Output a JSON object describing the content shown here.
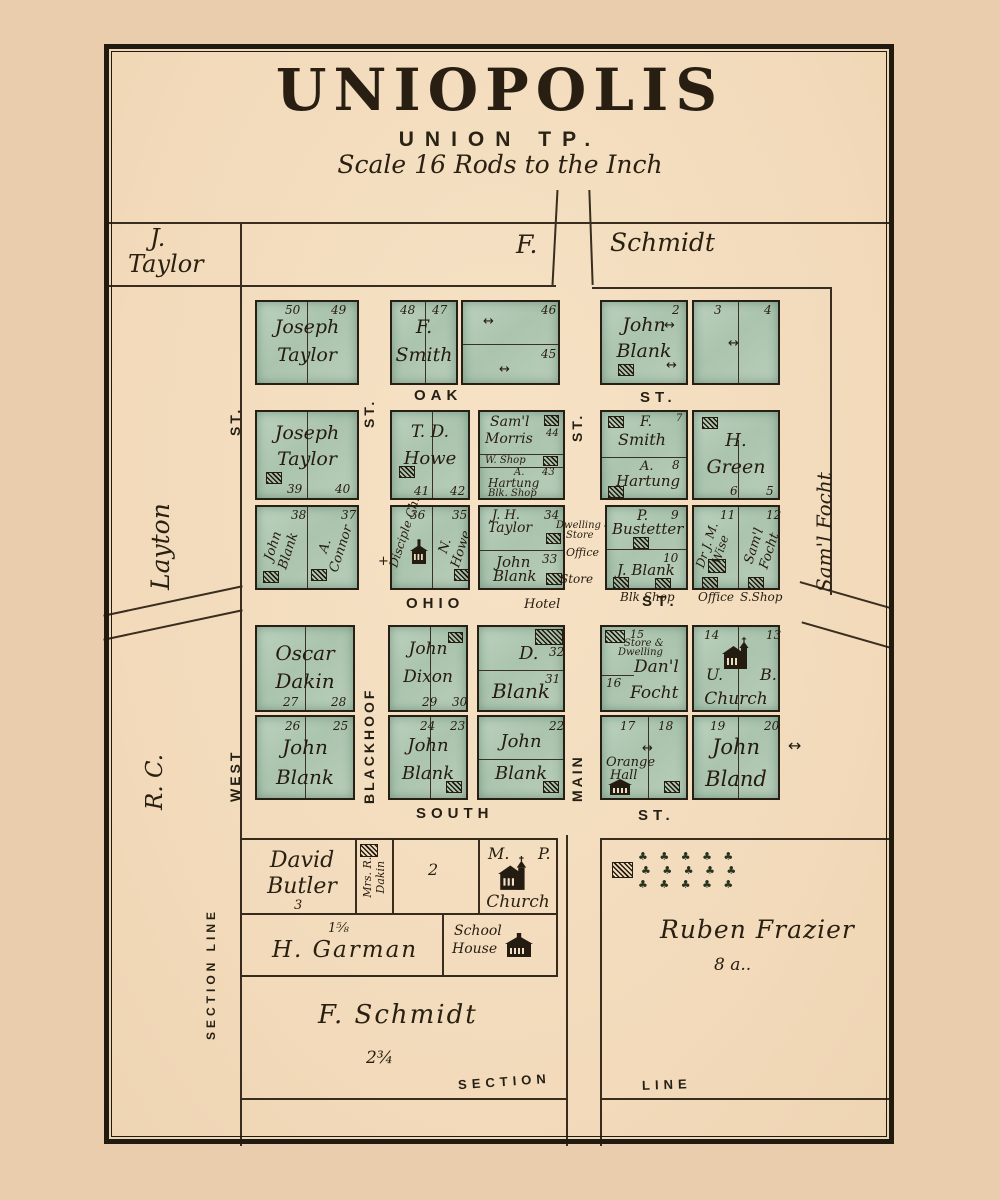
{
  "title": {
    "main": "UNIOPOLIS",
    "township": "UNION TP.",
    "scale": "Scale 16 Rods to the Inch"
  },
  "outer": {
    "nw1": "J.",
    "nw2": "Taylor",
    "f": "F.",
    "schmidt": "Schmidt",
    "layton": "Layton",
    "rc": "R.  C.",
    "east": "Sam'l  Focht",
    "section_line_v": "SECTION  LINE"
  },
  "streets": {
    "oak": "OAK",
    "ohio": "OHIO",
    "south": "SOUTH",
    "west": "WEST",
    "blackhoof": "BLACKHOOF",
    "main": "MAIN",
    "st": "ST.",
    "section": "SECTION",
    "line": "LINE"
  },
  "icons": {
    "tree_row": "♣ ♣ ♣ ♣ ♣",
    "arrow": "↔",
    "cross": "+"
  },
  "ann": {
    "hotel": "Hotel",
    "blk_shop": "Blk Shop",
    "office": "Office",
    "s_shop": "S.Shop",
    "store": "Store",
    "dwelling1": "Dwelling &",
    "dwelling2": "Store"
  },
  "blocks": {
    "r1b1": {
      "o1": "Joseph",
      "o2": "Taylor",
      "lA": "50",
      "lB": "49"
    },
    "r1b2": {
      "o1": "F.",
      "o2": "Smith",
      "lA": "48",
      "lB": "47",
      "lC": "46",
      "lD": "45"
    },
    "r1b3": {
      "o1": "John",
      "o2": "Blank",
      "lA": "2",
      "lB": "3",
      "lC": "4"
    },
    "r2b1": {
      "o1": "Joseph",
      "o2": "Taylor",
      "lA": "39",
      "lB": "40"
    },
    "r2b2": {
      "o1": "T. D.",
      "o2": "Howe",
      "lA": "41",
      "lB": "42"
    },
    "r2b3": {
      "m1": "Sam'l",
      "m2": "Morris",
      "mlot": "44",
      "wshop": "W. Shop",
      "h1": "A.",
      "h2": "Hartung",
      "hlot": "43",
      "bshop": "Blk. Shop"
    },
    "r2b4": {
      "s1": "F.",
      "s2": "Smith",
      "slot": "7",
      "h1": "A.",
      "h2": "Hartung",
      "hlot": "8"
    },
    "r2b5": {
      "o1": "H.",
      "o2": "Green",
      "lA": "6",
      "lB": "5"
    },
    "r3b1": {
      "a1": "John",
      "a2": "Blank",
      "alot": "38",
      "b1": "A.",
      "b2": "Connor",
      "blot": "37"
    },
    "r3b2": {
      "a": "Disciple Ch.",
      "alot": "36",
      "b1": "N.",
      "b2": "Howe",
      "blot": "35"
    },
    "r3b3": {
      "a1": "J. H.",
      "a2": "Taylor",
      "alot": "34",
      "b1": "John",
      "b2": "Blank",
      "blot": "33"
    },
    "r3b4": {
      "a1": "P.",
      "a2": "Bustetter",
      "alot": "9",
      "b": "J. Blank",
      "blot": "10"
    },
    "r3b5": {
      "a1": "Dr J. M.",
      "a2": "Wise",
      "alot": "11",
      "b1": "Sam'l",
      "b2": "Focht",
      "blot": "12"
    },
    "r4b1": {
      "o1": "Oscar",
      "o2": "Dakin",
      "lA": "27",
      "lB": "28"
    },
    "r4b2": {
      "o1": "John",
      "o2": "Dixon",
      "lA": "29",
      "lB": "30"
    },
    "r4b3": {
      "o1": "D.",
      "o2": "Blank",
      "lA": "32",
      "lB": "31"
    },
    "r4b4": {
      "lA": "15",
      "sd1": "Store &",
      "sd2": "Dwelling",
      "o1": "Dan'l",
      "o2": "Focht",
      "lB": "16"
    },
    "r4b5": {
      "u": "U.",
      "b": "B.",
      "church": "Church",
      "lA": "14",
      "lB": "13"
    },
    "r5b1": {
      "o1": "John",
      "o2": "Blank",
      "lA": "26",
      "lB": "25"
    },
    "r5b2": {
      "o1": "John",
      "o2": "Blank",
      "lA": "24",
      "lB": "23"
    },
    "r5b3": {
      "o1": "John",
      "o2": "Blank",
      "lA": "22"
    },
    "r5b4": {
      "o1": "Orange",
      "o2": "Hall",
      "lA": "17",
      "lB": "18"
    },
    "r5b5": {
      "o1": "John",
      "o2": "Bland",
      "lA": "19",
      "lB": "20"
    }
  },
  "bottom": {
    "david1": "David",
    "david2": "Butler",
    "david_lot": "3",
    "mrs1": "Mrs. R.",
    "mrs2": "Dakin",
    "two": "2",
    "mp1": "M.",
    "mp2": "P.",
    "mp_church": "Church",
    "garman_acres": "1⅝",
    "garman": "H. Garman",
    "school1": "School",
    "school2": "House",
    "fschmidt": "F.  Schmidt",
    "fs_acres": "2¾",
    "ruben": "Ruben  Frazier",
    "ruben_acres": "8 a.."
  }
}
